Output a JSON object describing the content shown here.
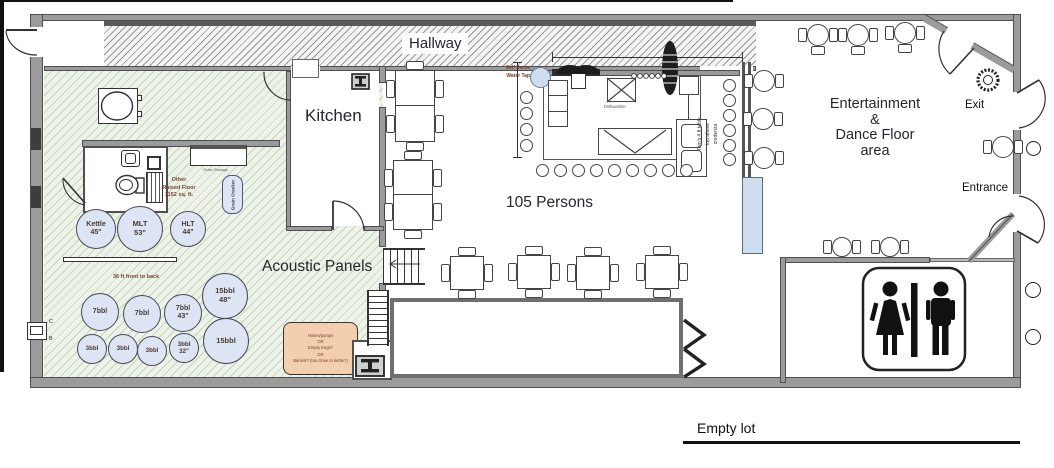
{
  "labels": {
    "hallway": "Hallway",
    "kitchen": "Kitchen",
    "persons": "105 Persons",
    "acoustic_panels": "Acoustic Panels",
    "exit": "Exit",
    "entrance": "Entrance",
    "empty_lot": "Empty lot",
    "dishwasher": "Dishwasher",
    "grain_storage": "Grain Storage",
    "grain_cracker": "Grain Cracker",
    "front_to_back": "36 ft front to back",
    "marker_c": "C",
    "marker_b": "B"
  },
  "entertainment": {
    "lines": [
      "Entertainment",
      "&",
      "Dance Floor",
      "area"
    ]
  },
  "self_serve": {
    "lines": [
      "Self Serve",
      "Water Tap"
    ]
  },
  "other_floor": {
    "lines": [
      "Other",
      "Raised Floor",
      "1152 sq. ft."
    ]
  },
  "toms_note": {
    "lines": [
      "Tom's 4 ft table",
      "top above",
      "credenza"
    ]
  },
  "storage_note": {
    "lines": [
      "Hoses/pumps",
      "OR",
      "Empty Kegs?",
      "OR",
      "Barrels? (too close to kettle?)"
    ]
  },
  "tanks": [
    {
      "l1": "Kettle",
      "l2": "45\""
    },
    {
      "l1": "MLT",
      "l2": "53\""
    },
    {
      "l1": "HLT",
      "l2": "44\""
    },
    {
      "l1": "7bbl",
      "l2": ""
    },
    {
      "l1": "7bbl",
      "l2": ""
    },
    {
      "l1": "7bbl",
      "l2": "43\""
    },
    {
      "l1": "15bbl",
      "l2": "48\""
    },
    {
      "l1": "3bbl",
      "l2": ""
    },
    {
      "l1": "3bbl",
      "l2": ""
    },
    {
      "l1": "3bbl",
      "l2": ""
    },
    {
      "l1": "3bbl",
      "l2": "32\""
    },
    {
      "l1": "15bbl",
      "l2": ""
    }
  ],
  "colors": {
    "wall": "#9b9b9b",
    "wall_edge": "#4f4f4f",
    "brewery_floor": "#edf3e8",
    "tank_fill": "#dde4f4",
    "note_fill": "#f2cfae",
    "accent_blue": "#cfdeee",
    "label_dark": "#26262e",
    "label_brown": "#7a4434"
  }
}
